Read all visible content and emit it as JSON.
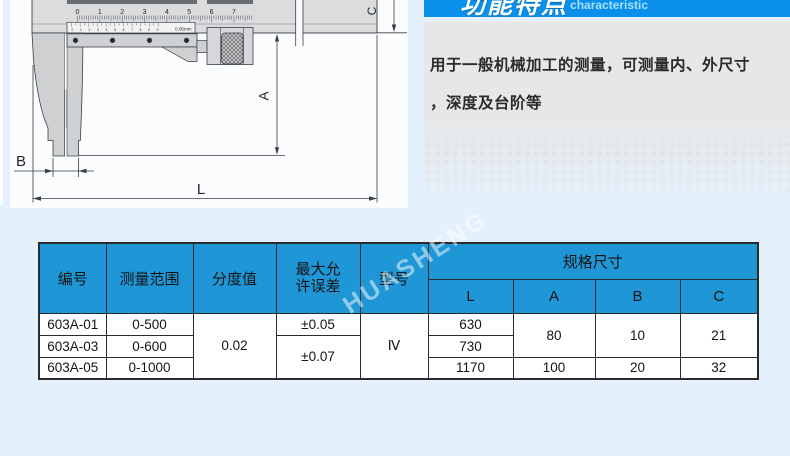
{
  "page": {
    "bg_color": "#e4f1fc"
  },
  "diagram": {
    "main_scale_numbers": [
      "0",
      "1",
      "2",
      "3",
      "4",
      "5",
      "6",
      "7"
    ],
    "vernier_numbers": "0 1 2 3 4 5 6 7 8 9 0",
    "vernier_label": "0.05mm",
    "label_a": "A",
    "label_b": "B",
    "label_c": "C",
    "label_l": "L"
  },
  "feature_panel": {
    "bar_color": "#0a90ea",
    "title": "功能特点",
    "subtitle": "characteristic",
    "desc_line1": "用于一般机械加工的测量，可测量内、外尺寸",
    "desc_line2": "，深度及台阶等"
  },
  "spec_table": {
    "header_bg": "#1f96d6",
    "watermark": "HUASHENG",
    "header": {
      "col_number": "编号",
      "col_range": "测量范围",
      "col_graduation": "分度值",
      "col_error_line1": "最大允",
      "col_error_line2": "许误差",
      "col_model": "型号",
      "col_size_group": "规格尺寸",
      "sub_cols": [
        "L",
        "A",
        "B",
        "C"
      ]
    },
    "rows": [
      {
        "id": "603A-01",
        "range": "0-500",
        "graduation": "0.02",
        "error": "±0.05",
        "model": "Ⅳ",
        "l": "630",
        "a": "80",
        "b": "10",
        "c": "21"
      },
      {
        "id": "603A-03",
        "range": "0-600",
        "error": "±0.07",
        "l": "730"
      },
      {
        "id": "603A-05",
        "range": "0-1000",
        "l": "1170",
        "a": "100",
        "b": "20",
        "c": "32"
      }
    ]
  }
}
